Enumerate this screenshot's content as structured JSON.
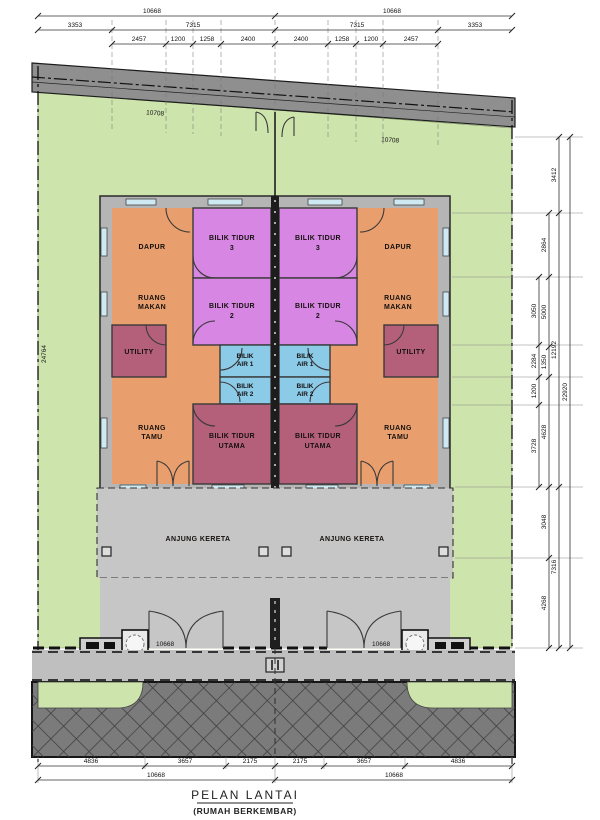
{
  "title": {
    "main": "PELAN LANTAI",
    "sub": "(RUMAH BERKEMBAR)"
  },
  "colors": {
    "lot_green": "#cde4ad",
    "band_gray": "#8f8f8f",
    "wall_gray": "#b5b5b5",
    "porch_gray": "#c6c6c6",
    "sidewalk_gray": "#bfbfbf",
    "road_gray": "#7b7b7b",
    "room_orange": "#e99f6d",
    "room_violet": "#d787e3",
    "room_rose": "#b5607a",
    "room_blue": "#8ccbe8"
  },
  "dims": {
    "top_row1": [
      "10668",
      "10668"
    ],
    "top_row2": [
      "3353",
      "7315",
      "7315",
      "3353"
    ],
    "top_row3": [
      "2457",
      "1200",
      "1258",
      "2400",
      "2400",
      "1258",
      "1200",
      "2457"
    ],
    "roof": [
      "10708",
      "10708"
    ],
    "left_boundary": "24764",
    "right_a": [
      "3050",
      "2284",
      "1200",
      "3728"
    ],
    "right_b": [
      "2864",
      "5000",
      "1350",
      "4628",
      "3048",
      "4268"
    ],
    "right_c": [
      "3412",
      "12192",
      "7316"
    ],
    "right_d": [
      "22920"
    ],
    "gate": [
      "10668",
      "10668"
    ],
    "bottom_row1": [
      "4836",
      "3657",
      "2175",
      "2175",
      "3657",
      "4836"
    ],
    "bottom_row2": [
      "10668",
      "10668"
    ]
  },
  "rooms": {
    "dapur": "DAPUR",
    "bilik_tidur": "BILIK TIDUR",
    "no3": "3",
    "no2": "2",
    "ruang": "RUANG",
    "makan": "MAKAN",
    "tamu": "TAMU",
    "utility": "UTILITY",
    "bilik": "BILIK",
    "air1": "AIR 1",
    "air2": "AIR 2",
    "utama": "UTAMA",
    "anjung_kereta": "ANJUNG KERETA"
  }
}
